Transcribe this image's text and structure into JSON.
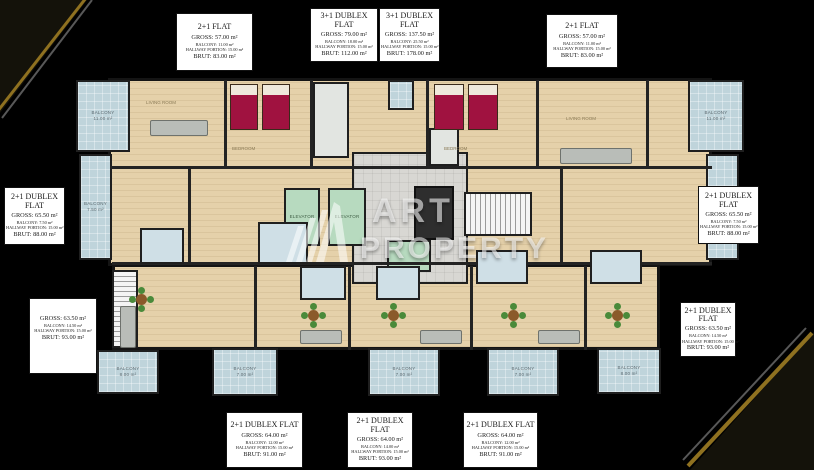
{
  "watermark": {
    "line1": "ART",
    "line2": "PROPERTY"
  },
  "colors": {
    "background": "#000000",
    "accent_gold": "#8f7120",
    "balcony_blue": "#bfd4db",
    "floor_beige": "#e5d1aa",
    "elevator_green": "#b7dabf",
    "bed_red": "#a01240",
    "label_bg": "#ffffff"
  },
  "flat_labels": [
    {
      "title": "2+1 FLAT",
      "gross": "GROSS: 57.00 m²",
      "balcony": "BALCONY: 11.00 m²",
      "hallway": "HALLWAY PORTION: 15.00 m²",
      "brut": "BRUT: 83.00 m²"
    },
    {
      "title": "3+1 DUBLEX FLAT",
      "gross": "GROSS: 79.00 m²",
      "balcony": "BALCONY: 18.00 m²",
      "hallway": "HALLWAY PORTION: 15.00 m²",
      "brut": "BRUT: 112.00 m²"
    },
    {
      "title": "3+1 DUBLEX FLAT",
      "gross": "GROSS: 137.50 m²",
      "balcony": "BALCONY: 25.50 m²",
      "hallway": "HALLWAY PORTION: 15.00 m²",
      "brut": "BRUT: 178.00 m²"
    },
    {
      "title": "2+1 FLAT",
      "gross": "GROSS: 57.00 m²",
      "balcony": "BALCONY: 11.00 m²",
      "hallway": "HALLWAY PORTION: 15.00 m²",
      "brut": "BRUT: 83.00 m²"
    },
    {
      "title": "2+1 DUBLEX FLAT",
      "gross": "GROSS: 65.50 m²",
      "balcony": "BALCONY: 7.50 m²",
      "hallway": "HALLWAY PORTION: 15.00 m²",
      "brut": "BRUT: 88.00 m²"
    },
    {
      "title": "2+1 DUBLEX FLAT",
      "gross": "GROSS: 65.50 m²",
      "balcony": "BALCONY: 7.50 m²",
      "hallway": "HALLWAY PORTION: 15.00 m²",
      "brut": "BRUT: 88.00 m²"
    },
    {
      "title": "",
      "gross": "GROSS: 63.50 m²",
      "balcony": "BALCONY: 14.50 m²",
      "hallway": "HALLWAY PORTION: 15.00 m²",
      "brut": "BRUT: 93.00 m²"
    },
    {
      "title": "2+1 DUBLEX FLAT",
      "gross": "GROSS: 63.50 m²",
      "balcony": "BALCONY: 14.50 m²",
      "hallway": "HALLWAY PORTION: 15.00 m²",
      "brut": "BRUT: 93.00 m²"
    },
    {
      "title": "2+1 DUBLEX FLAT",
      "gross": "GROSS: 64.00 m²",
      "balcony": "BALCONY: 12.00 m²",
      "hallway": "HALLWAY PORTION: 15.00 m²",
      "brut": "BRUT: 91.00 m²"
    },
    {
      "title": "2+1 DUBLEX FLAT",
      "gross": "GROSS: 64.00 m²",
      "balcony": "BALCONY: 14.00 m²",
      "hallway": "HALLWAY PORTION: 15.00 m²",
      "brut": "BRUT: 93.00 m²"
    },
    {
      "title": "2+1 DUBLEX FLAT",
      "gross": "GROSS: 64.00 m²",
      "balcony": "BALCONY: 12.00 m²",
      "hallway": "HALLWAY PORTION: 15.00 m²",
      "brut": "BRUT: 91.00 m²"
    }
  ],
  "rooms": {
    "balcony_top_left": "BALCONY\n11.00 m²",
    "balcony_top_right": "BALCONY\n11.00 m²",
    "balcony_left": "BALCONY\n7.50 m²",
    "balcony_right": "BALCONY\n7.50 m²",
    "balcony_b1": "BALCONY\n8.00 m²",
    "balcony_b2": "BALCONY\n7.00 m²",
    "balcony_b3": "BALCONY\n7.00 m²",
    "balcony_b4": "BALCONY\n7.00 m²",
    "balcony_b5": "BALCONY\n8.00 m²",
    "elevator": "ELEVATOR",
    "living_room": "LIVING ROOM",
    "bedroom": "BEDROOM"
  }
}
